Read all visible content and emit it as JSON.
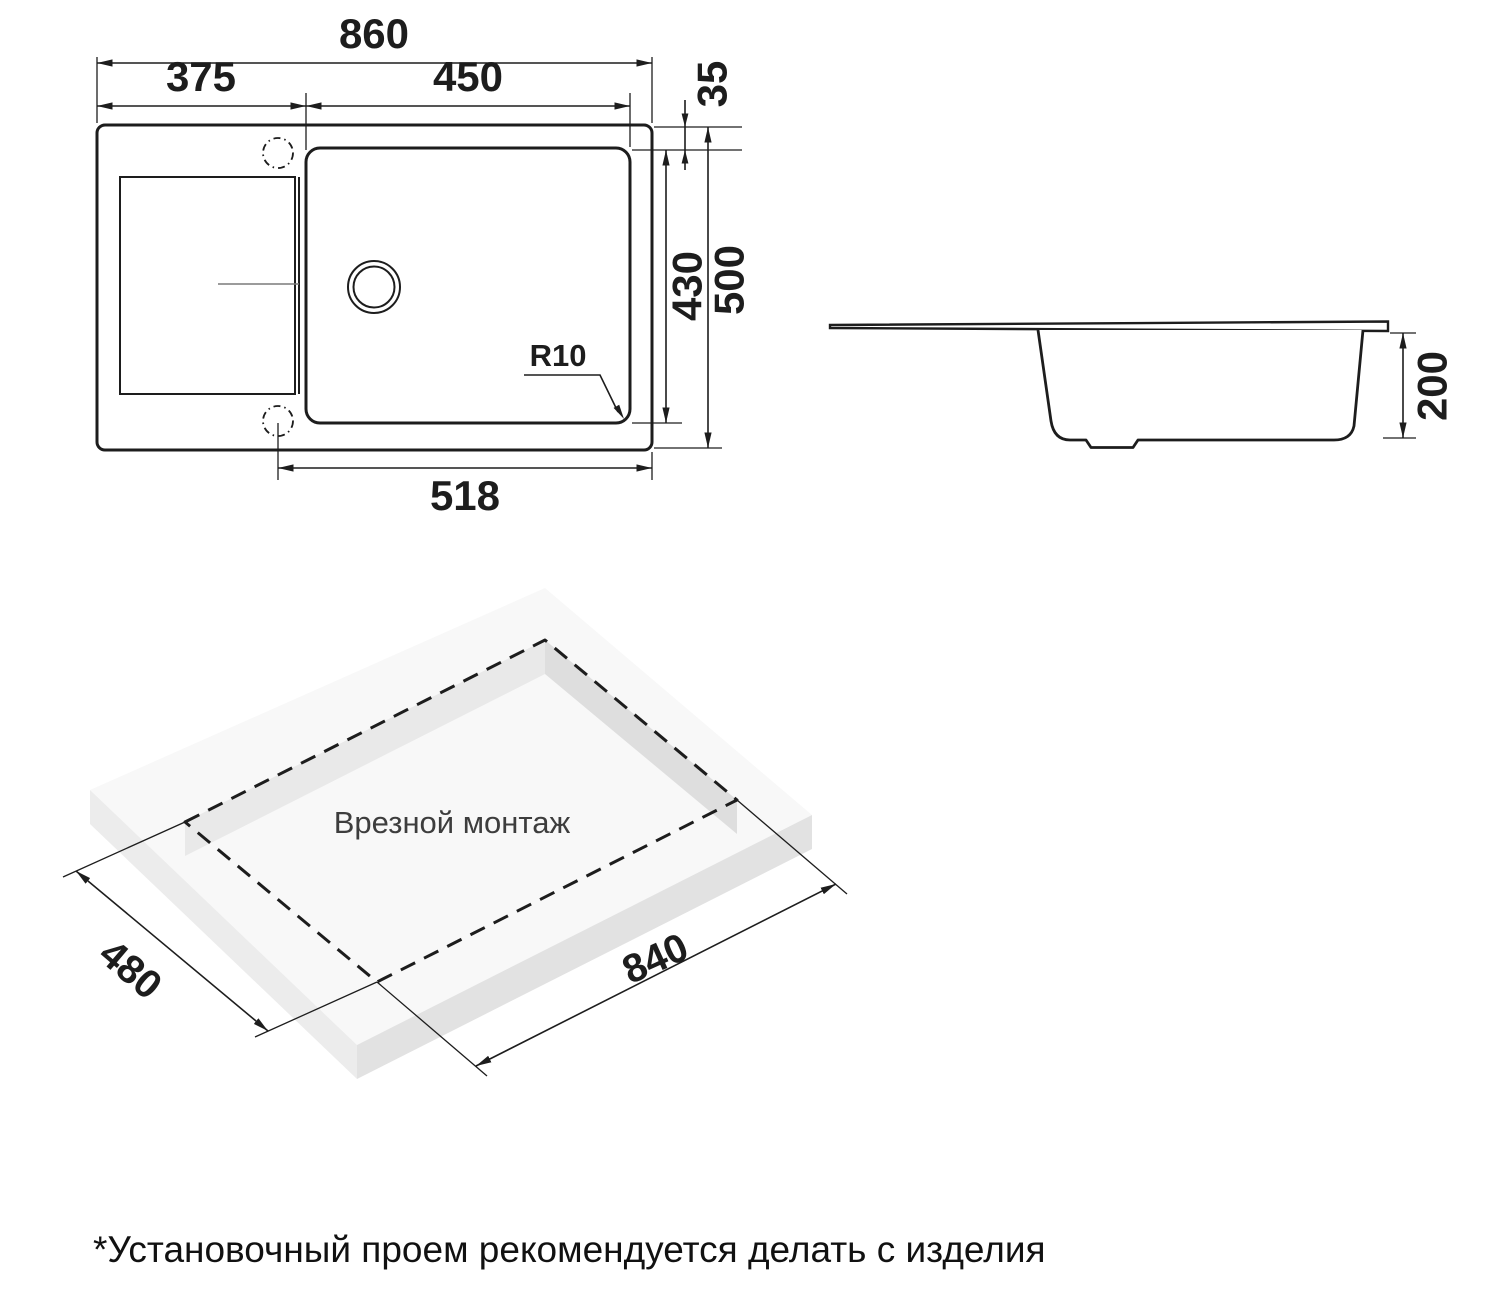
{
  "top_view": {
    "total_width": "860",
    "left_section_width": "375",
    "bowl_width": "450",
    "top_offset": "35",
    "bowl_length": "430",
    "total_depth": "500",
    "hole_to_edge": "518",
    "corner_radius_label": "R10"
  },
  "side_view": {
    "bowl_depth": "200"
  },
  "installation_view": {
    "caption": "Врезной монтаж",
    "cutout_length": "840",
    "cutout_width": "480"
  },
  "footnote": "*Установочный проем рекомендуется делать с изделия",
  "colors": {
    "line": "#1d1d1d",
    "surface_top": "#f8f8f8",
    "surface_side_left": "#ececec",
    "surface_side_right": "#e2e2e2",
    "background": "#ffffff"
  }
}
